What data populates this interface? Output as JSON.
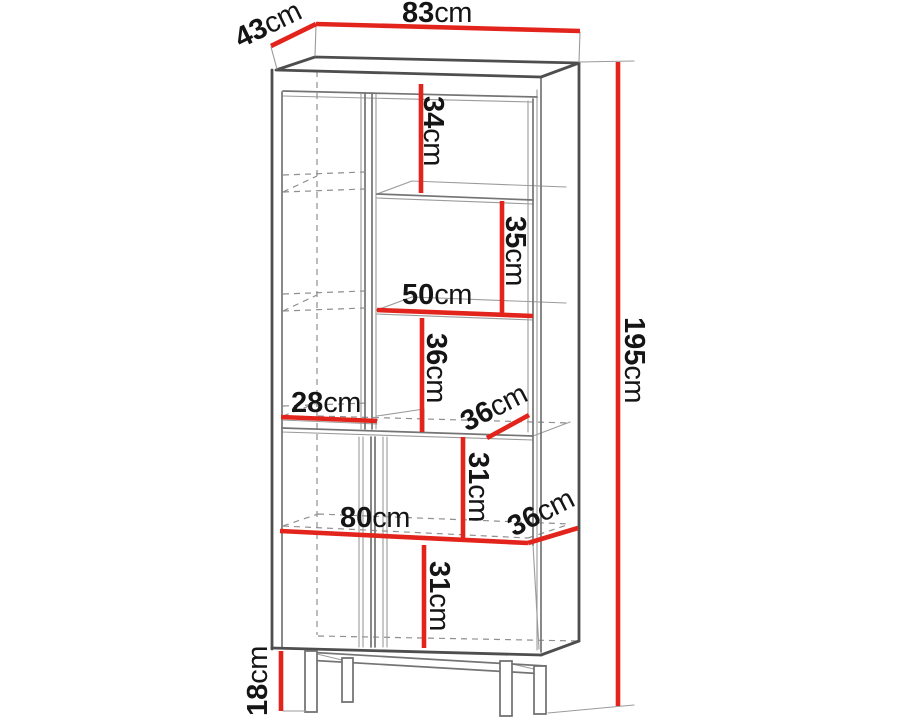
{
  "diagram": {
    "title": "Display cabinet dimension drawing",
    "unit": "cm"
  },
  "colors": {
    "dimension_line": "#e3241c",
    "outline_dark": "#4e4e4e",
    "outline_mid": "#747474",
    "outline_light": "#9b9b9b",
    "dashed_line": "#8f8f8f",
    "label_text": "#151515",
    "background": "#ffffff"
  },
  "labels": {
    "d83": {
      "value": "83",
      "unit": "cm"
    },
    "d43": {
      "value": "43",
      "unit": "cm"
    },
    "d195": {
      "value": "195",
      "unit": "cm"
    },
    "d34": {
      "value": "34",
      "unit": "cm"
    },
    "d35": {
      "value": "35",
      "unit": "cm"
    },
    "d50": {
      "value": "50",
      "unit": "cm"
    },
    "d36_upper": {
      "value": "36",
      "unit": "cm"
    },
    "d28": {
      "value": "28",
      "unit": "cm"
    },
    "d36_middle": {
      "value": "36",
      "unit": "cm"
    },
    "d31_upper": {
      "value": "31",
      "unit": "cm"
    },
    "d80": {
      "value": "80",
      "unit": "cm"
    },
    "d36_lower": {
      "value": "36",
      "unit": "cm"
    },
    "d31_lower": {
      "value": "31",
      "unit": "cm"
    },
    "d18": {
      "value": "18",
      "unit": "cm"
    }
  }
}
